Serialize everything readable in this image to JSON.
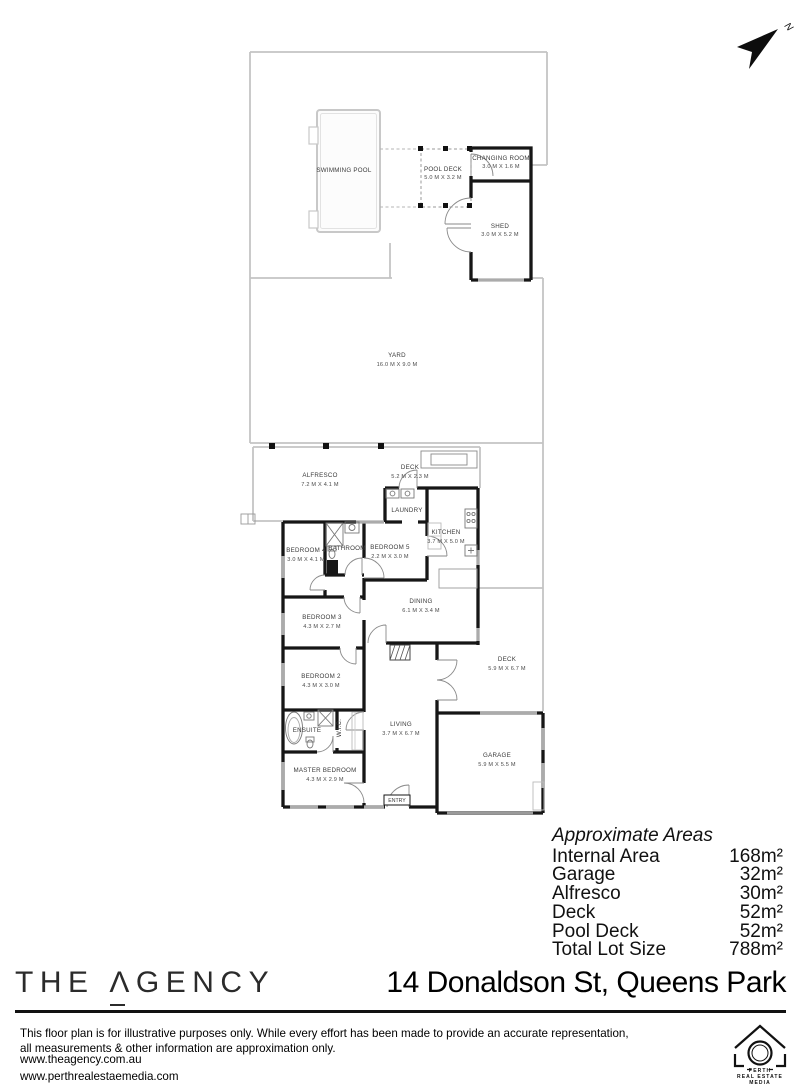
{
  "colors": {
    "wall": "#161616",
    "boundary": "#c4c4c4",
    "window": "#ababab",
    "label_text": "#3a3a3a"
  },
  "compass": {
    "north_label": "N"
  },
  "floorplan": {
    "rooms": [
      {
        "name": "SWIMMING POOL",
        "dims": ""
      },
      {
        "name": "POOL DECK",
        "dims": "5.0 M X 3.2 M"
      },
      {
        "name": "CHANGING ROOM",
        "dims": "3.0 M X 1.6 M"
      },
      {
        "name": "SHED",
        "dims": "3.0 M X 5.2 M"
      },
      {
        "name": "YARD",
        "dims": "16.0 M X 9.0 M"
      },
      {
        "name": "ALFRESCO",
        "dims": "7.2 M X 4.1 M"
      },
      {
        "name": "DECK",
        "dims": "5.2 M X 2.3 M"
      },
      {
        "name": "LAUNDRY",
        "dims": ""
      },
      {
        "name": "KITCHEN",
        "dims": "3.7 M X 5.0 M"
      },
      {
        "name": "BATHROOM",
        "dims": ""
      },
      {
        "name": "BEDROOM 4",
        "dims": "3.0 M X 4.1 M"
      },
      {
        "name": "BEDROOM 5",
        "dims": "2.2 M X 3.0 M"
      },
      {
        "name": "DINING",
        "dims": "6.1 M X 3.4 M"
      },
      {
        "name": "BEDROOM 3",
        "dims": "4.3 M X 2.7 M"
      },
      {
        "name": "BEDROOM 2",
        "dims": "4.3 M X 3.0 M"
      },
      {
        "name": "DECK",
        "dims": "5.9 M X 6.7 M"
      },
      {
        "name": "ENSUITE",
        "dims": ""
      },
      {
        "name": "W.I.C.",
        "dims": ""
      },
      {
        "name": "MASTER BEDROOM",
        "dims": "4.3 M X 2.9 M"
      },
      {
        "name": "LIVING",
        "dims": "3.7 M X 6.7 M"
      },
      {
        "name": "GARAGE",
        "dims": "5.9 M X 5.5 M"
      },
      {
        "name": "ENTRY",
        "dims": ""
      }
    ]
  },
  "areas": {
    "title": "Approximate Areas",
    "rows": [
      {
        "label": "Internal Area",
        "value": "168m²"
      },
      {
        "label": "Garage",
        "value": "32m²"
      },
      {
        "label": "Alfresco",
        "value": "30m²"
      },
      {
        "label": "Deck",
        "value": "52m²"
      },
      {
        "label": "Pool Deck",
        "value": "52m²"
      },
      {
        "label": "Total Lot Size",
        "value": "788m²"
      }
    ]
  },
  "footer": {
    "brand": {
      "word_the": "THE",
      "letter_a": "Λ",
      "word_rest": "GENCY"
    },
    "address": "14 Donaldson St, Queens Park"
  },
  "disclaimer": {
    "line1": "This floor plan is for illustrative purposes only. While every effort has been made to provide an accurate representation,",
    "line2": "all measurements & other information are approximation only."
  },
  "links": {
    "site1": "www.theagency.com.au",
    "site2": "www.perthrealestaemedia.com"
  },
  "media_logo": {
    "line1": "PERTH",
    "line2": "REAL ESTATE",
    "line3": "MEDIA"
  }
}
